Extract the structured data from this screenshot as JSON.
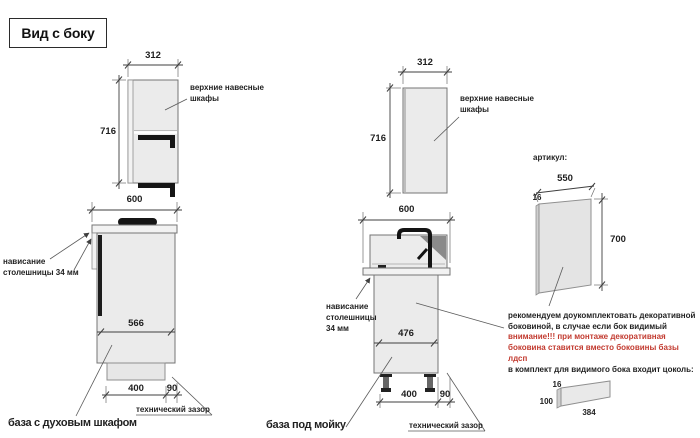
{
  "title": "Вид с боку",
  "labels": {
    "upper_cabinets_line1": "верхние навесные",
    "upper_cabinets_line2": "шкафы",
    "tech_gap": "технический зазор",
    "article": "артикул:"
  },
  "oven_base": {
    "upper_width": "312",
    "upper_height": "716",
    "counter_width": "600",
    "inner_width": "566",
    "plinth_width": "400",
    "gap": "90",
    "overhang_line1": "нависание",
    "overhang_line2": "столешницы 34 мм",
    "caption": "база с духовым шкафом"
  },
  "sink_base": {
    "upper_width": "312",
    "upper_height": "716",
    "counter_width": "600",
    "inner_width": "476",
    "plinth_width": "400",
    "gap": "90",
    "overhang_line1": "нависание",
    "overhang_line2": "столешницы",
    "overhang_line3": "34 мм",
    "caption": "база под мойку"
  },
  "side_panel": {
    "width": "550",
    "thickness": "16",
    "height": "700"
  },
  "note": {
    "line1": "рекомендуем доукомплектовать декоративной",
    "line2": "боковиной, в случае если бок видимый",
    "line3": "внимание!!! при монтаже декоративная",
    "line4": "боковина ставится вместо боковины базы лдсп",
    "line5": "в комплект для видимого бока входит цоколь:"
  },
  "plinth_panel": {
    "thickness": "16",
    "height": "100",
    "width": "384"
  },
  "colors": {
    "warning_red": "#c23a2f",
    "line_gray": "#3f3f3f",
    "cabinet_fill": "#ebebeb"
  }
}
